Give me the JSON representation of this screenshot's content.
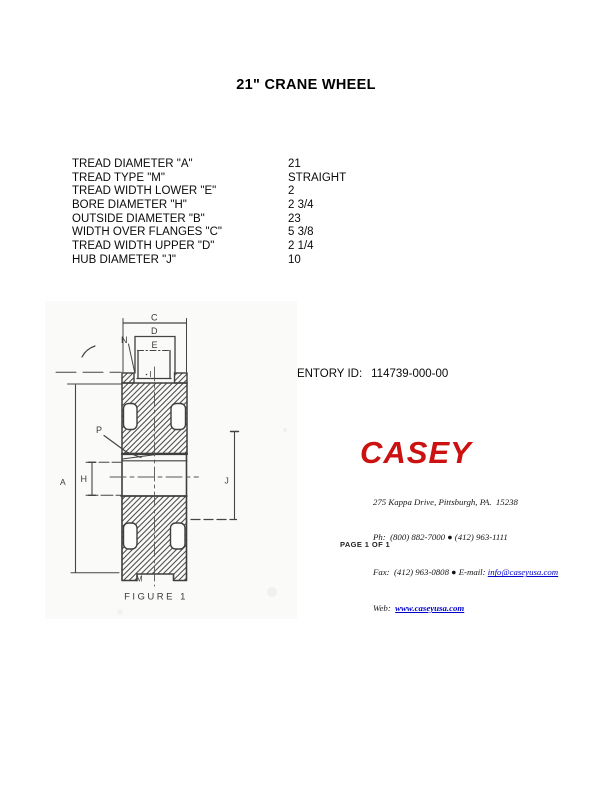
{
  "title": "21\" CRANE WHEEL",
  "specs": {
    "rows": [
      {
        "label": "TREAD DIAMETER \"A\"",
        "value": "21"
      },
      {
        "label": "TREAD TYPE \"M\"",
        "value": "STRAIGHT"
      },
      {
        "label": "TREAD WIDTH LOWER \"E\"",
        "value": "2"
      },
      {
        "label": "BORE DIAMETER \"H\"",
        "value": "2 3/4"
      },
      {
        "label": "OUTSIDE DIAMETER \"B\"",
        "value": "23"
      },
      {
        "label": "WIDTH OVER FLANGES \"C\"",
        "value": "5 3/8"
      },
      {
        "label": "TREAD WIDTH UPPER \"D\"",
        "value": "2 1/4"
      },
      {
        "label": "HUB DIAMETER \"J\"",
        "value": "10"
      }
    ]
  },
  "inventory": {
    "label": "INVENTORY ID:",
    "value": "114739-000-00"
  },
  "figure": {
    "caption": "FIGURE  1",
    "dims": {
      "c": "C",
      "d": "D",
      "e": "E",
      "n": "N",
      "i": "I",
      "p": "P",
      "a": "A",
      "h": "H",
      "j": "J",
      "m": "M"
    }
  },
  "company": {
    "name": "CASEY",
    "address": "275 Kappa Drive, Pittsburgh, PA.  15238",
    "phone_line": "Ph:  (800) 882-7000 ● (412) 963-1111",
    "fax_label": "Fax:  (412) 963-0808 ● E-mail: ",
    "email": "info@caseyusa.com",
    "web_label": "Web:  ",
    "website": "www.caseyusa.com"
  },
  "footer": {
    "page_label": "PAGE 1 OF 1"
  },
  "colors": {
    "brand_red": "#cc1111",
    "link_blue": "#0000cc"
  }
}
